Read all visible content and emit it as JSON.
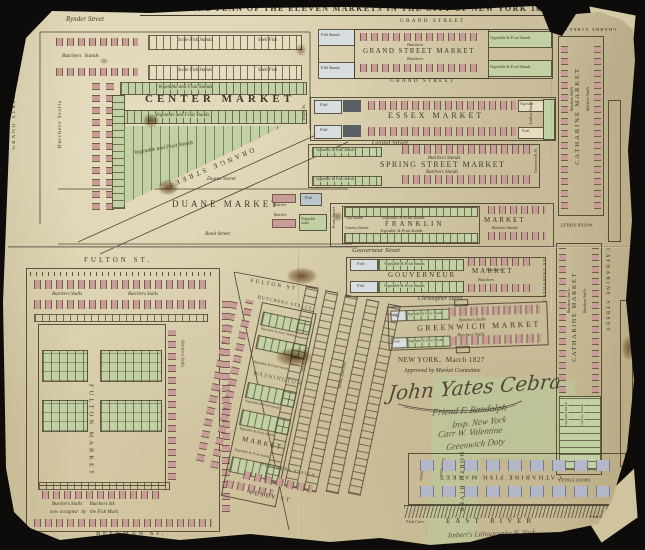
{
  "title": "THE GROUND PLAN OF THE ELEVEN MARKETS IN THE CITY OF NEW YORK 1827.",
  "streets": {
    "rynder": "Rynder Street",
    "grand_vertical": "GRAND STREET",
    "orange": "ORANGE STREET",
    "duane": "Duane Street",
    "reed": "Reed Street",
    "grand_upper": "GRAND STREET",
    "grand_lower": "GRAND STREET",
    "grand_script": "Grand Street",
    "gouverneur": "Gouverneur Street",
    "christopher": "Christopher Street",
    "essex": "Essex St.",
    "ludlow": "Ludlow Street",
    "greenwich": "Greenwich St.",
    "front_franklin": "Front Street",
    "catharine_st_gouverneur": "CATHARINE ST.",
    "fulton_st": "FULTON ST.",
    "beekman": "BEEKMAN ST.",
    "fulton_washington": "FULTON ST",
    "vesey": "VESEY ST",
    "cherry": "CHERRY STREET",
    "water": "WATER STREET",
    "front_catharine": "FRONT STREET",
    "catharine_street": "CATHARINE STREET",
    "north_river": "NORTH RIVER",
    "east_river": "EAST RIVER"
  },
  "markets": {
    "center": {
      "name": "CENTER MARKET",
      "butchers_stalls": "Butchers Stalls",
      "butchers_stands": "Butchers  Stands",
      "scale_fish": "Scale Fish Stands",
      "shell_fish": "Shell Fish",
      "veg": "Vegetable and Fruit Stands"
    },
    "grand": {
      "name": "GRAND STREET MARKET",
      "butchers": "Butchers",
      "fish_stands": "Fish Stands",
      "veg": "Vegetable & Fruit Stands"
    },
    "essex": {
      "name": "ESSEX MARKET",
      "fish": "Fish",
      "vegetable": "Vegetable",
      "fruit": "Fruit"
    },
    "spring": {
      "name": "SPRING STREET MARKET",
      "butchers_stands": "Butchers Stands",
      "veg": "Vegetable & Fruit Stands"
    },
    "franklin": {
      "name": "FRANKLIN",
      "market_word": "MARKET",
      "veg": "Vegetable & Fruit Stands",
      "slip_stands": "Slip Stands",
      "country_stands": "Country Stands",
      "butchers_stands": "Butchers Stands"
    },
    "gouverneur": {
      "name": "GOUVERNEUR",
      "market_word": "MARKET",
      "fish": "Fish",
      "veg": "Vegetable & Fruit Stands",
      "butchers": "Butchers"
    },
    "greenwich": {
      "name": "GREENWICH MARKET",
      "butchers_stalls": "Butchers Stalls",
      "veg": "Vegetable & Fruit Stands",
      "fish": "Fish"
    },
    "duane": {
      "name": "DUANE MARKET",
      "butcher": "Butcher",
      "fish": "Fish",
      "veg_stand": "Vegetable stand"
    },
    "fulton": {
      "name": "FULTON MARKET",
      "butchers_stalls": "Butchers Stalls",
      "note1": "Butchers Stalls      Butchers Stk",
      "note2": "now occupied   by   the Fish Mark"
    },
    "washington": {
      "name_line1": "WASHINGTON",
      "name_line2": "MARKET",
      "butchers_stalls": "BUTCHERS STALLS",
      "veg": "Vegetable & Fruit Stands",
      "country_stands": "Country Stands",
      "vegetable_stands": "Vegetable Stands",
      "fruit_stands": "Fruit Stands",
      "fish_stands": "Fish Stands"
    },
    "catharine": {
      "name": "CATHARINE MARKET",
      "butchers_stalls": "Butchers Stalls",
      "vegetable_stands": "Vegetable Stands",
      "country_stands": "Country Stands",
      "fish_name": "CATHARINE FISH MARKET",
      "fish_cars": "Fish Cars"
    }
  },
  "note": {
    "place_date": "NEW YORK,  March 1827",
    "approved": "Approved by Market Committee"
  },
  "signatures": {
    "s1": "John Yates Cebra",
    "s2": "Friend F. Randolph",
    "s3": "Insp. New York",
    "s4": "Carr W. Valentine",
    "s5": "Greenwich Doty"
  },
  "imprint": "Imbert's Lithography N. York",
  "colors": {
    "paper": "#d9cfae",
    "ink": "#3f372a",
    "stand_green": "#c2d1a4",
    "stall_red": "#c79e97",
    "cell_blue": "#b9c6cd",
    "stall_gray": "#a9aec0",
    "background": "#0d0c0a"
  }
}
